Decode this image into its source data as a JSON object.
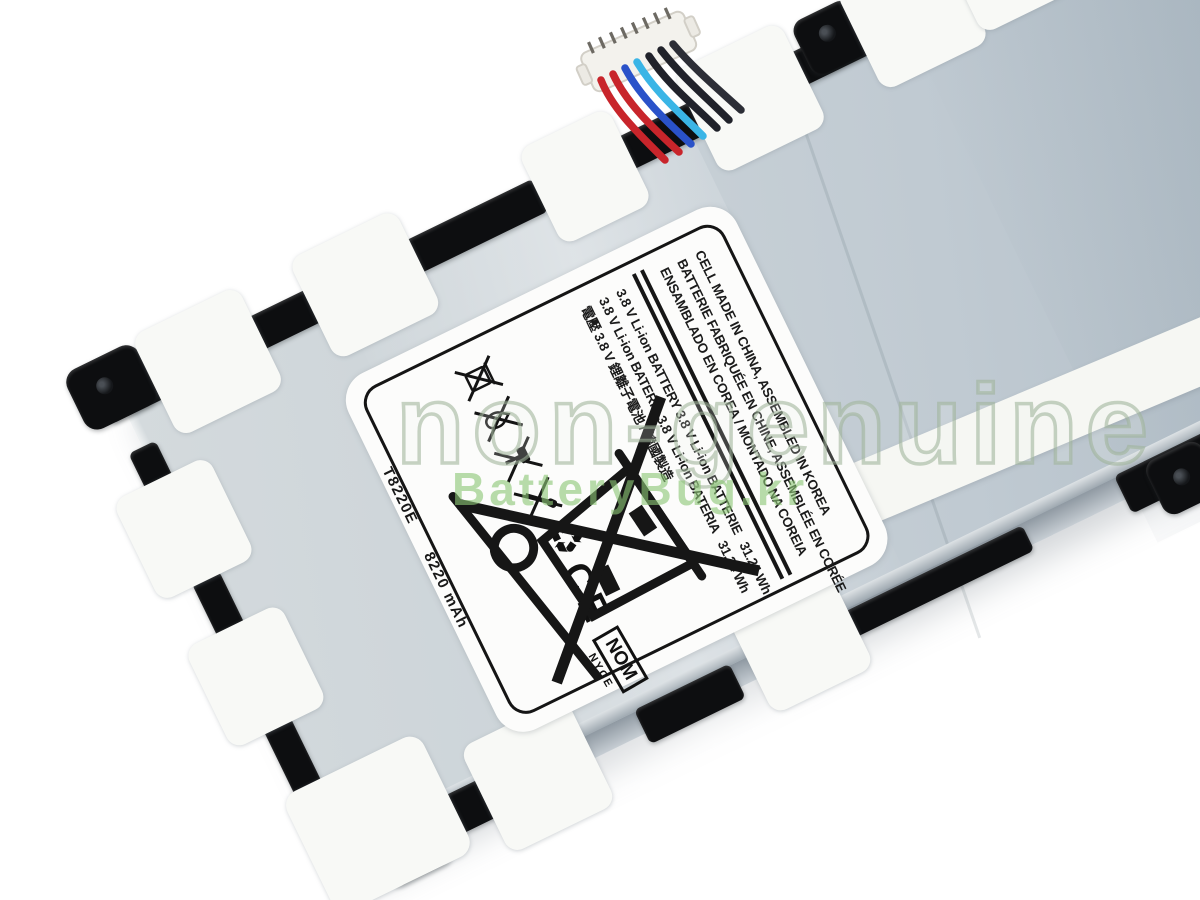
{
  "photo": {
    "subject": "tablet-battery-product-photo"
  },
  "label": {
    "model": "T8220E",
    "capacity": "8220 mAh",
    "model_capacity": "T8220E  8220 mAh",
    "lines": [
      "CELL MADE IN CHINA, ASSEMBLED IN KOREA",
      "BATTERIE FABRIQUÉE EN CHINE, ASSEMBLÉE EN CORÉE",
      "ENSAMBLADO EN COREA / MONTADO NA COREIA",
      "3.8 V Li-ion BATTERY 3.8 V Li-ion BATTERIE   31.24 Wh",
      "3.8 V Li-ion BATERÍA 3.8 V Li-ion BATERIA   31.24 Wh",
      "電壓 3.8 V 鋰離子電池 / 韓國製造"
    ],
    "marks": {
      "recycle": "♻",
      "ce": "CE",
      "nom": "NOM",
      "nyce": "NYCE"
    },
    "icon_names": [
      "crossed-trash-icon",
      "crossed-fire-icon",
      "crossed-hammer-icon",
      "crossed-screwdriver-icon",
      "recycling-icon",
      "ce-mark",
      "nom-nyce-mark",
      "battery-arrows-icon",
      "crossed-wheelie-bin-icon"
    ]
  },
  "watermark": {
    "line1": "non-genuine",
    "line2": "BatteryBug.kr"
  },
  "colors": {
    "background": "#ffffff",
    "battery_surface": "#c3ccd3",
    "frame_black": "#0d0e10",
    "tape_white": "#f8f9f6",
    "label_white": "#fcfcfb",
    "label_ink": "#1b1b1b",
    "wire_red": "#c8252b",
    "wire_blue": "#2a52c9",
    "wire_cyan": "#3ab5e6",
    "wire_black": "#20222a",
    "watermark_green": "#8ec678"
  }
}
